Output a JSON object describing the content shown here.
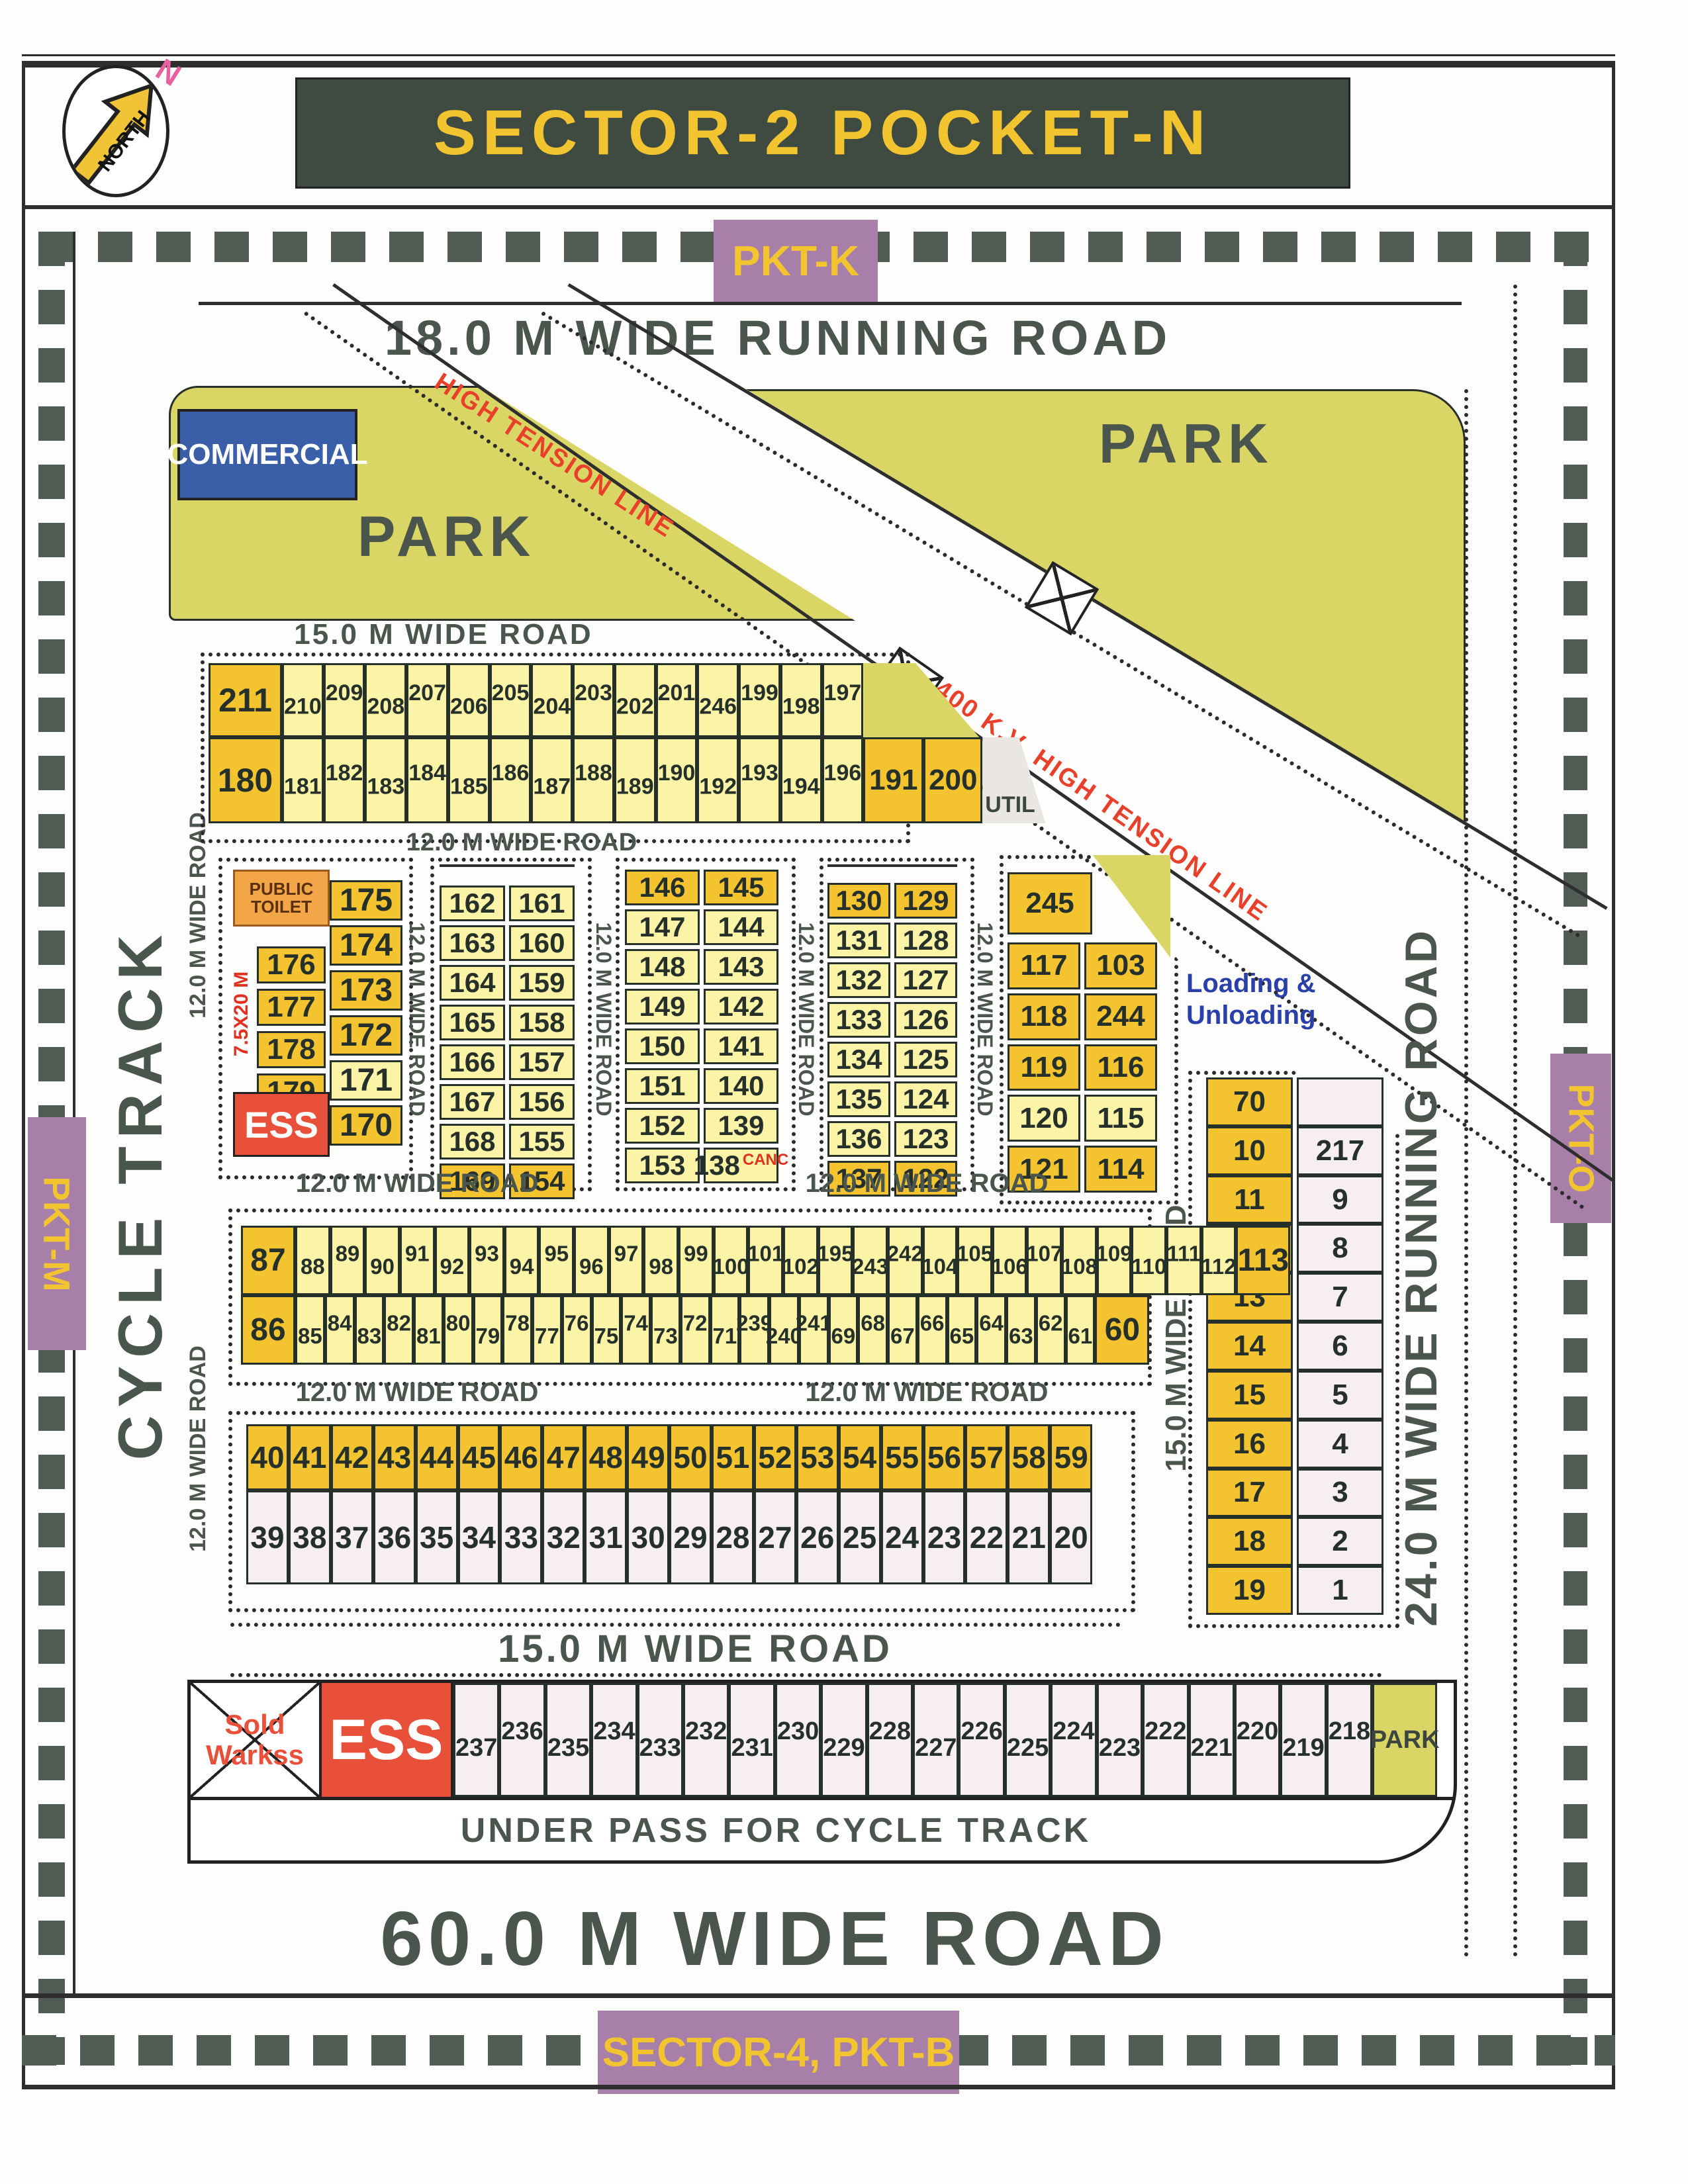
{
  "title": "SECTOR-2 POCKET-N",
  "north": {
    "word": "NORTH",
    "letter": "N"
  },
  "margins": {
    "pkt_k": "PKT-K",
    "pkt_m": "PKT-M",
    "pkt_o": "PKT-O",
    "sector4": "SECTOR-4, PKT-B"
  },
  "roads": {
    "r18": "18.0 M WIDE RUNNING ROAD",
    "r24": "24.0 M WIDE RUNNING ROAD",
    "r60": "60.0 M WIDE ROAD",
    "r15": "15.0 M WIDE ROAD",
    "r12": "12.0 M WIDE ROAD",
    "cycle": "CYCLE TRACK",
    "underpass": "UNDER PASS FOR CYCLE TRACK"
  },
  "corridor": {
    "ht": "HIGH TENSION LINE",
    "ht400": "400 K.V. HIGH TENSION LINE"
  },
  "areas": {
    "park": "PARK",
    "commercial": "COMMERCIAL",
    "toilet1": "PUBLIC",
    "toilet2": "TOILET",
    "ess": "ESS",
    "sold1": "Sold",
    "sold2": "Warkss",
    "util": "UTIL",
    "loading1": "Loading &",
    "loading2": "Unloading",
    "dim": "7.5X20 M",
    "canc": "CANC"
  },
  "colors": {
    "dark_yellow": "#f4c430",
    "light_yellow": "#fbf3a6",
    "pale_pink": "#f6eef1",
    "park_green": "#d9d666",
    "purple": "#a77fa9",
    "label_yellow": "#f2c430",
    "ess_red": "#e8503a",
    "title_bg": "#3f4a41",
    "road_text": "#4a554e",
    "loading_blue": "#2b3fa8",
    "canc_red": "#e03020",
    "ht_red": "#e8402a"
  },
  "top_block": {
    "row1_wide": "211",
    "row1": [
      "210",
      "209",
      "208",
      "207",
      "206",
      "205",
      "204",
      "203",
      "202",
      "201",
      "246",
      "199",
      "198",
      "197"
    ],
    "row2_wide": "180",
    "row2": [
      "181",
      "182",
      "183",
      "184",
      "185",
      "186",
      "187",
      "188",
      "189",
      "190",
      "192",
      "193",
      "194",
      "196"
    ],
    "p191": "191",
    "p200": "200"
  },
  "block1": {
    "cells_left": [
      "176",
      "177",
      "178",
      "179"
    ],
    "cells_right": [
      {
        "n": "175",
        "c": "dy"
      },
      {
        "n": "174",
        "c": "dy"
      },
      {
        "n": "173",
        "c": "dy"
      },
      {
        "n": "172",
        "c": "dy"
      },
      {
        "n": "171",
        "c": "ly"
      },
      {
        "n": "170",
        "c": "dy"
      }
    ]
  },
  "block2": {
    "rows": [
      {
        "a": "162",
        "b": "161",
        "c": "ly"
      },
      {
        "a": "163",
        "b": "160",
        "c": "ly"
      },
      {
        "a": "164",
        "b": "159",
        "c": "ly"
      },
      {
        "a": "165",
        "b": "158",
        "c": "ly"
      },
      {
        "a": "166",
        "b": "157",
        "c": "ly"
      },
      {
        "a": "167",
        "b": "156",
        "c": "ly"
      },
      {
        "a": "168",
        "b": "155",
        "c": "ly"
      },
      {
        "a": "169",
        "b": "154",
        "c": "dy"
      }
    ]
  },
  "block3": {
    "rows": [
      {
        "a": "146",
        "b": "145",
        "c": "dy"
      },
      {
        "a": "147",
        "b": "144",
        "c": "ly"
      },
      {
        "a": "148",
        "b": "143",
        "c": "ly"
      },
      {
        "a": "149",
        "b": "142",
        "c": "ly"
      },
      {
        "a": "150",
        "b": "141",
        "c": "ly"
      },
      {
        "a": "151",
        "b": "140",
        "c": "ly"
      },
      {
        "a": "152",
        "b": "139",
        "c": "ly"
      },
      {
        "a": "153",
        "b": "138",
        "c": "ly",
        "tag": "CANC"
      }
    ]
  },
  "block4": {
    "rows": [
      {
        "a": "130",
        "b": "129",
        "c": "dy"
      },
      {
        "a": "131",
        "b": "128",
        "c": "ly"
      },
      {
        "a": "132",
        "b": "127",
        "c": "ly"
      },
      {
        "a": "133",
        "b": "126",
        "c": "ly"
      },
      {
        "a": "134",
        "b": "125",
        "c": "ly"
      },
      {
        "a": "135",
        "b": "124",
        "c": "ly"
      },
      {
        "a": "136",
        "b": "123",
        "c": "ly"
      },
      {
        "a": "137",
        "b": "122",
        "c": "dy"
      }
    ]
  },
  "block5": {
    "top": "245",
    "rows": [
      {
        "a": "117",
        "b": "103",
        "c": "dy"
      },
      {
        "a": "118",
        "b": "244",
        "c": "dy"
      },
      {
        "a": "119",
        "b": "116",
        "c": "dy"
      },
      {
        "a": "120",
        "b": "115",
        "c": "ly"
      },
      {
        "a": "121",
        "b": "114",
        "c": "dy"
      }
    ]
  },
  "right_block": {
    "rows": [
      {
        "a": "70",
        "b": "",
        "ca": "dy",
        "cb": "wh"
      },
      {
        "a": "10",
        "b": "217",
        "ca": "dy",
        "cb": "wh"
      },
      {
        "a": "11",
        "b": "9",
        "ca": "dy",
        "cb": "wh"
      },
      {
        "a": "12",
        "b": "8",
        "ca": "dy",
        "cb": "wh"
      },
      {
        "a": "13",
        "b": "7",
        "ca": "dy",
        "cb": "wh"
      },
      {
        "a": "14",
        "b": "6",
        "ca": "dy",
        "cb": "wh"
      },
      {
        "a": "15",
        "b": "5",
        "ca": "dy",
        "cb": "wh"
      },
      {
        "a": "16",
        "b": "4",
        "ca": "dy",
        "cb": "wh"
      },
      {
        "a": "17",
        "b": "3",
        "ca": "dy",
        "cb": "wh"
      },
      {
        "a": "18",
        "b": "2",
        "ca": "dy",
        "cb": "wh"
      },
      {
        "a": "19",
        "b": "1",
        "ca": "dy",
        "cb": "wh"
      }
    ]
  },
  "long_rows": {
    "a_wide_left": "87",
    "a": [
      "88",
      "89",
      "90",
      "91",
      "92",
      "93",
      "94",
      "95",
      "96",
      "97",
      "98",
      "99",
      "100",
      "101",
      "102",
      "195",
      "243",
      "242",
      "104",
      "105",
      "106",
      "107",
      "108",
      "109",
      "110",
      "111",
      "112"
    ],
    "a_wide_right": "113",
    "b_wide_left": "86",
    "b": [
      "85",
      "84",
      "83",
      "82",
      "81",
      "80",
      "79",
      "78",
      "77",
      "76",
      "75",
      "74",
      "73",
      "72",
      "71",
      "239",
      "240",
      "241",
      "69",
      "68",
      "67",
      "66",
      "65",
      "64",
      "63",
      "62",
      "61"
    ],
    "b_wide_right": "60"
  },
  "forty_block": {
    "row_top": [
      "40",
      "41",
      "42",
      "43",
      "44",
      "45",
      "46",
      "47",
      "48",
      "49",
      "50",
      "51",
      "52",
      "53",
      "54",
      "55",
      "56",
      "57",
      "58",
      "59"
    ],
    "row_bottom": [
      "39",
      "38",
      "37",
      "36",
      "35",
      "34",
      "33",
      "32",
      "31",
      "30",
      "29",
      "28",
      "27",
      "26",
      "25",
      "24",
      "23",
      "22",
      "21",
      "20"
    ]
  },
  "bottom_strip": {
    "plots": [
      "237",
      "236",
      "235",
      "234",
      "233",
      "232",
      "231",
      "230",
      "229",
      "228",
      "227",
      "226",
      "225",
      "224",
      "223",
      "222",
      "221",
      "220",
      "219",
      "218"
    ],
    "park": "PARK"
  }
}
